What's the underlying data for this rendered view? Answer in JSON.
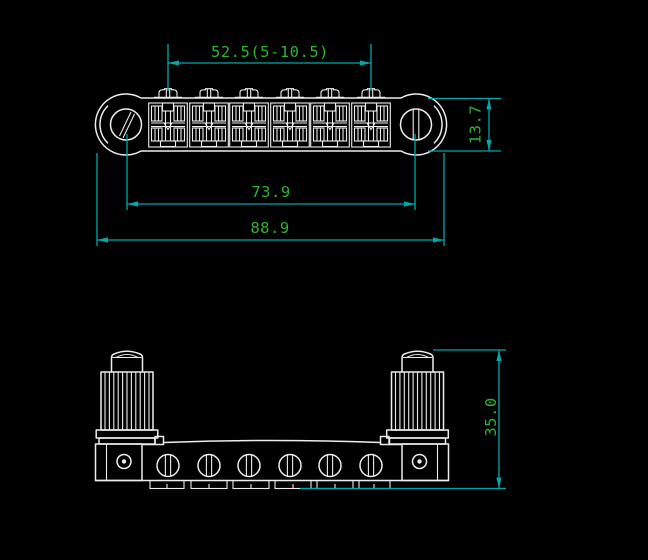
{
  "colors": {
    "bg": "#000000",
    "line": "#ededed",
    "dim": "#00a8ae",
    "label": "#2db32d"
  },
  "dimensions": {
    "string_spread": {
      "label": "52.5(5-10.5)"
    },
    "bridge_width": {
      "label": "13.7"
    },
    "post_spacing": {
      "label": "73.9"
    },
    "overall_length": {
      "label": "88.9"
    },
    "overall_height": {
      "label": "35.0"
    }
  }
}
